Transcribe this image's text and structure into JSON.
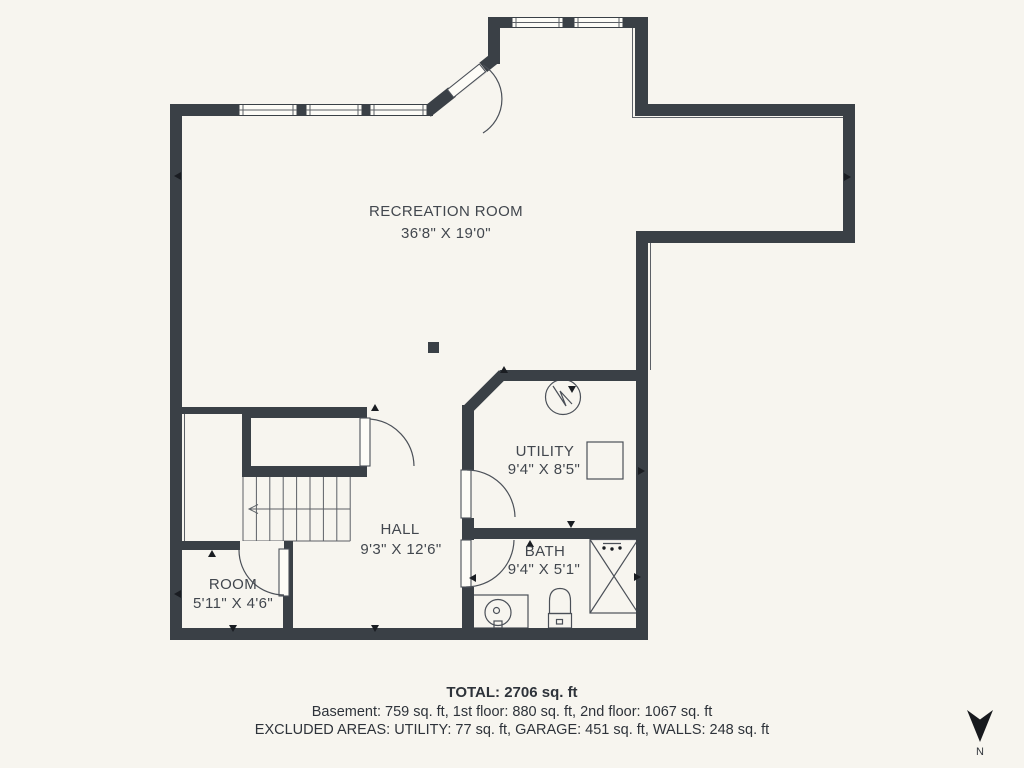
{
  "plan": {
    "rooms": [
      {
        "label": "RECREATION ROOM",
        "dims": "36'8\" X 19'0\""
      },
      {
        "label": "UTILITY",
        "dims": "9'4\" X 8'5\""
      },
      {
        "label": "HALL",
        "dims": "9'3\" X 12'6\""
      },
      {
        "label": "BATH",
        "dims": "9'4\" X 5'1\""
      },
      {
        "label": "ROOM",
        "dims": "5'11\" X 4'6\""
      }
    ]
  },
  "summary": {
    "total": "TOTAL: 2706 sq. ft",
    "floors": "Basement: 759 sq. ft, 1st floor: 880 sq. ft, 2nd floor: 1067 sq. ft",
    "excluded": "EXCLUDED AREAS: UTILITY: 77 sq. ft, GARAGE: 451 sq. ft, WALLS: 248 sq. ft"
  },
  "compass": {
    "north_label": "N"
  },
  "colors": {
    "wall": "#3a4046",
    "background": "#f7f5ef",
    "accent_line": "#4b5058",
    "text": "#42474e"
  }
}
